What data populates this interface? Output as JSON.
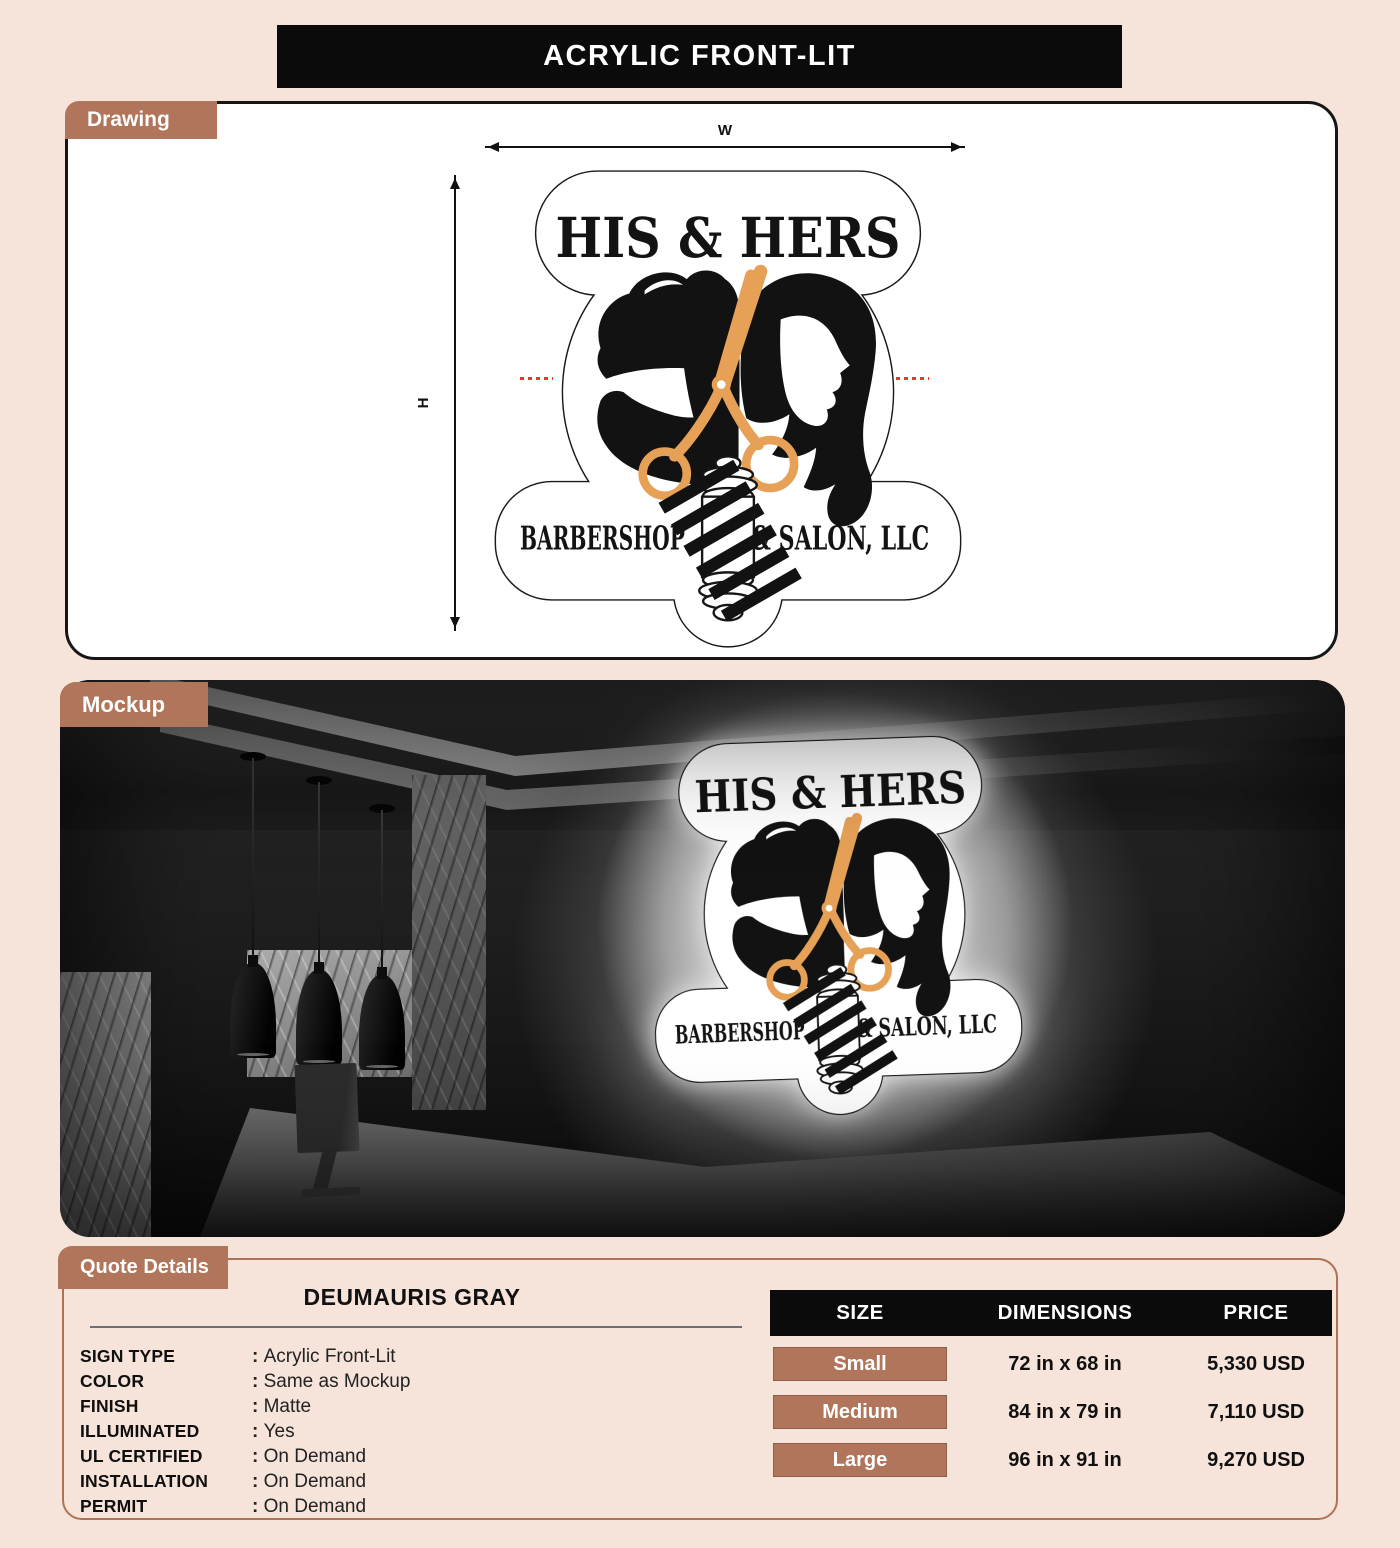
{
  "page": {
    "title": "ACRYLIC FRONT-LIT"
  },
  "colors": {
    "page-bg": "#f6e3d9",
    "accent-brown": "#b0755a",
    "banner-black": "#0b0b0b",
    "scissors-orange": "#e6a156",
    "guide-red": "#e8392b",
    "panel-border-brown": "#ad7352"
  },
  "sign": {
    "line1": "HIS & HERS",
    "line2_left": "BARBERSHOP",
    "line2_right": "& SALON, LLC"
  },
  "drawing": {
    "tab_label": "Drawing",
    "width_label": "W",
    "height_label": "H"
  },
  "mockup": {
    "tab_label": "Mockup"
  },
  "quote": {
    "tab_label": "Quote Details",
    "customer_name": "DEUMAURIS GRAY",
    "specs": [
      {
        "label": "SIGN TYPE",
        "value": "Acrylic Front-Lit"
      },
      {
        "label": "COLOR",
        "value": "Same as Mockup"
      },
      {
        "label": "FINISH",
        "value": "Matte"
      },
      {
        "label": "ILLUMINATED",
        "value": "Yes"
      },
      {
        "label": "UL CERTIFIED",
        "value": "On Demand"
      },
      {
        "label": "INSTALLATION",
        "value": "On Demand"
      },
      {
        "label": "PERMIT",
        "value": "On Demand"
      }
    ],
    "pricing": {
      "headers": [
        "SIZE",
        "DIMENSIONS",
        "PRICE"
      ],
      "rows": [
        {
          "size": "Small",
          "dimensions": "72 in x 68 in",
          "price": "5,330 USD"
        },
        {
          "size": "Medium",
          "dimensions": "84 in x 79 in",
          "price": "7,110 USD"
        },
        {
          "size": "Large",
          "dimensions": "96 in x 91 in",
          "price": "9,270 USD"
        }
      ]
    }
  }
}
